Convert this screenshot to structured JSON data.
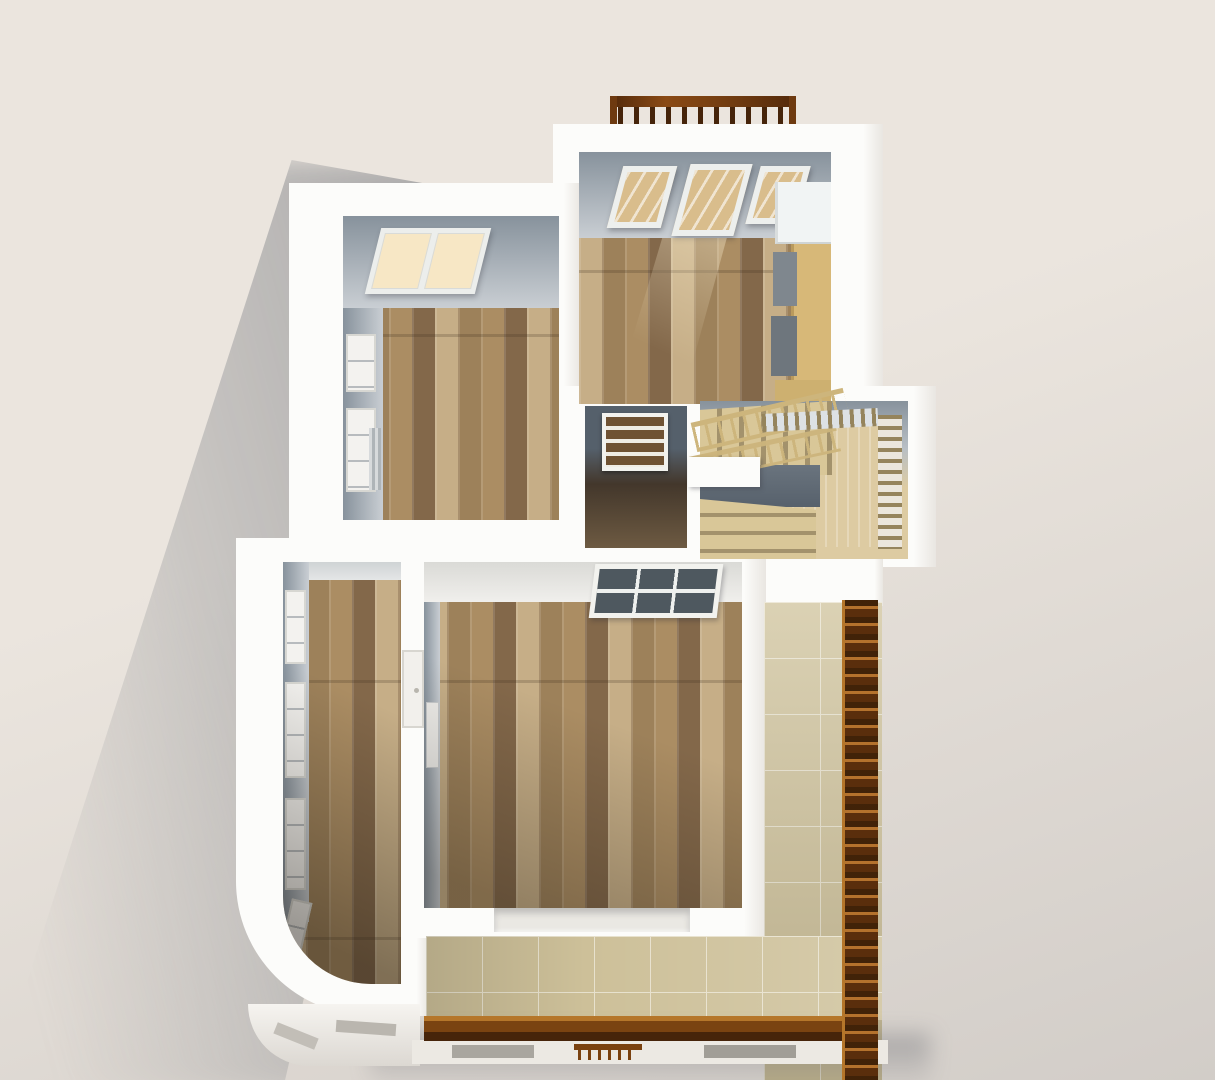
{
  "scene": {
    "kind": "3d-floorplan-render",
    "view": "overhead cutaway of an apartment upper floor, light from upper right, soft shadow cast to lower left",
    "visible_text": "none"
  },
  "palette": {
    "bgLight": "#ebe5de",
    "bgDark": "#d2cdc8",
    "wallWhite": "#fcfcfa",
    "wallShade": "#e9e6e1",
    "innerWallDark": "#87929c",
    "innerWallLight": "#c9ced3",
    "hallFloorDark": "#43372b",
    "hallFloorLight": "#6d5a42",
    "woodBase": "#ab8d63",
    "woodLight": "#c6ae87",
    "woodMid": "#9d815a",
    "woodDark": "#83684a",
    "stairTread": "#d9c798",
    "stairGap": "#a3926c",
    "stairRailWood": "#cdb57c",
    "stairLanding": "#ddcba2",
    "stairWellDark": "#57616c",
    "balusterWood": "#95845c",
    "tileBase": "#cdc099",
    "tileLine": "#e7e1cd",
    "railBrown": "#7a4311",
    "railDark": "#46240a",
    "railLight": "#b5762a",
    "glowWarm": "#f7e7c5",
    "blindTan": "#d9bd8c",
    "fridgeWhite": "#f1f4f4",
    "counterTan": "#d7b878",
    "applianceGrey": "#7f878e",
    "glassDark": "#4e585f",
    "frameWhite": "#f2f2ee",
    "doorWood": "#6f5233"
  },
  "rooms": [
    {
      "id": "kitchen",
      "floor": "wood-plank",
      "features": [
        "three-blind-windows",
        "fridge",
        "counter-with-appliances",
        "balcony-railing-outside"
      ]
    },
    {
      "id": "living-room",
      "floor": "wood-plank",
      "features": [
        "double-window-top-wall",
        "side-windows",
        "radiator"
      ]
    },
    {
      "id": "hallway",
      "floor": "dark-wood",
      "features": [
        "louvered-panel-door"
      ]
    },
    {
      "id": "stairwell",
      "floor": "light-wood-landing",
      "features": [
        "u-shaped-stairs",
        "wood-handrail",
        "baluster-screens"
      ]
    },
    {
      "id": "curved-corridor",
      "floor": "wood-plank",
      "features": [
        "curved-outer-wall",
        "window-row"
      ]
    },
    {
      "id": "bedroom",
      "floor": "wood-plank",
      "features": [
        "glazed-door-top-wall",
        "wall-fixture",
        "recessed-exterior-window"
      ]
    },
    {
      "id": "terrace",
      "floor": "beige-tile",
      "features": [
        "brown-wood-railing-right",
        "brown-wood-railing-bottom"
      ]
    }
  ],
  "exterior": {
    "lower_floor_hints": [
      "window-slots-under-terrace",
      "small-wood-balcony",
      "curved-lower-wall"
    ]
  }
}
